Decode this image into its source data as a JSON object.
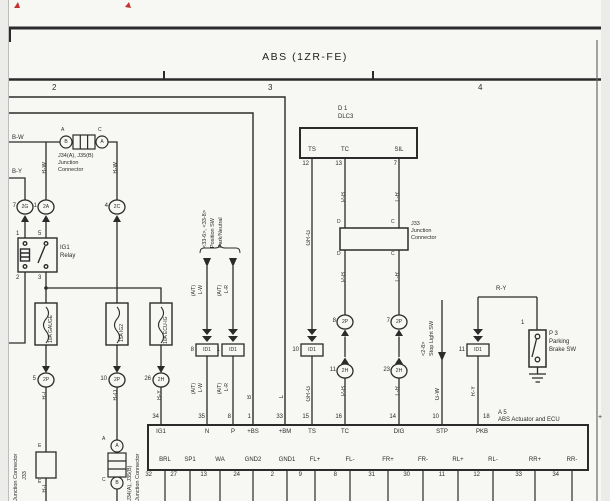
{
  "header": {
    "title": "ABS (1ZR-FE)",
    "grid2": "2",
    "grid3": "3",
    "grid4": "4",
    "plus": "+"
  },
  "jc_top": {
    "line1": "J34(A), J35(B)",
    "line2": "Junction",
    "line3": "Connector",
    "outer_left": "A",
    "outer_right": "C",
    "pin_left": "B",
    "pin_right": "A"
  },
  "wires": {
    "bw": "B-W",
    "by": "B-Y",
    "bw_v_left": "B-W",
    "bw_v_right": "B-W",
    "rl": "R-L",
    "bo": "B-O",
    "by_v": "B-Y",
    "b_bus": "B",
    "l_bus": "L",
    "grg_upper": "GR-G",
    "grg_lower": "GR-G",
    "pb_upper": "P-B",
    "pb_mid": "P-B",
    "pb_lower": "P-B",
    "lr_upper": "L-R",
    "lr_mid": "L-R",
    "lr_lower": "L-R",
    "lw_upper": "L-W",
    "lw_lower": "L-W",
    "lrat_upper": "L-R",
    "lrat_lower": "L-R",
    "at": "(A/T)",
    "gw": "G-W",
    "ry_v": "R-Y",
    "ry_h": "R-Y",
    "rl_bottom": "R-L"
  },
  "relay": {
    "name1": "IG1",
    "name2": "Relay",
    "pin1": "1",
    "pin5": "5",
    "pin2": "2",
    "pin3": "3"
  },
  "conn": {
    "c7": "7",
    "c7l": "2G",
    "c1": "1",
    "c1l": "2A",
    "c4": "4",
    "c4l": "2C",
    "c5": "5",
    "c5l": "2P",
    "c10": "10",
    "c10l": "2P",
    "c26": "26",
    "c26l": "2H",
    "m8": "8",
    "m8l": "2P",
    "m7": "7",
    "m7l": "2P",
    "m11": "11",
    "m11l": "2H",
    "m23": "23",
    "m23l": "2H"
  },
  "fuses": {
    "f1": "10A GAUGE",
    "f2": "15A IG2",
    "f3": "10A ECU-IG"
  },
  "dlc3": {
    "id": "D 1",
    "name": "DLC3",
    "ts": "TS",
    "tc": "TC",
    "sil": "SIL",
    "p12": "12",
    "p13": "13",
    "p7": "7"
  },
  "j33m": {
    "line1": "J33",
    "line2": "Junction",
    "line3": "Connector",
    "d_top": "D",
    "c_top": "C",
    "d_bot": "D",
    "c_bot": "C"
  },
  "id1": {
    "label": "ID1",
    "n10": "10",
    "n8": "8",
    "n1": "1",
    "n11": "11"
  },
  "pnp": {
    "line1": "Park/Neutral",
    "line2": "Position SW",
    "line3": "<33-6>, <33-8>"
  },
  "stop": {
    "line1": "Stop Light SW",
    "line2": "<2-8>"
  },
  "pkb_sw": {
    "pin1": "1",
    "l1": "P 3",
    "l2": "Parking",
    "l3": "Brake SW"
  },
  "ecu": {
    "l1": "A 5",
    "l2": "ABS Actuator and ECU",
    "top": [
      [
        "34",
        "IG1"
      ],
      [
        "35",
        "N"
      ],
      [
        "8",
        "P"
      ],
      [
        "1",
        "+BS"
      ],
      [
        "33",
        "+BM"
      ],
      [
        "15",
        "TS"
      ],
      [
        "16",
        "TC"
      ],
      [
        "14",
        "DIG"
      ],
      [
        "10",
        "STP"
      ],
      [
        "18",
        "PKB"
      ]
    ],
    "bottom": [
      [
        "32",
        "BRL"
      ],
      [
        "27",
        "SP1"
      ],
      [
        "13",
        "WA"
      ],
      [
        "24",
        "GND2"
      ],
      [
        "2",
        "GND1"
      ],
      [
        "9",
        "FL+"
      ],
      [
        "8",
        "FL-"
      ],
      [
        "31",
        "FR+"
      ],
      [
        "30",
        "FR-"
      ],
      [
        "11",
        "RL+"
      ],
      [
        "12",
        "RL-"
      ],
      [
        "33",
        "RR+"
      ],
      [
        "34",
        "RR-"
      ]
    ]
  },
  "jc_bot": {
    "line1": "J34(A), J35(B)",
    "line2": "Junction Connector",
    "a_out": "A",
    "c_out": "C",
    "a_pin": "A",
    "b_pin": "B"
  },
  "j33_bot": {
    "name": "J33",
    "name2": "Junction Connector",
    "e_top": "E",
    "e_bot": "E"
  }
}
